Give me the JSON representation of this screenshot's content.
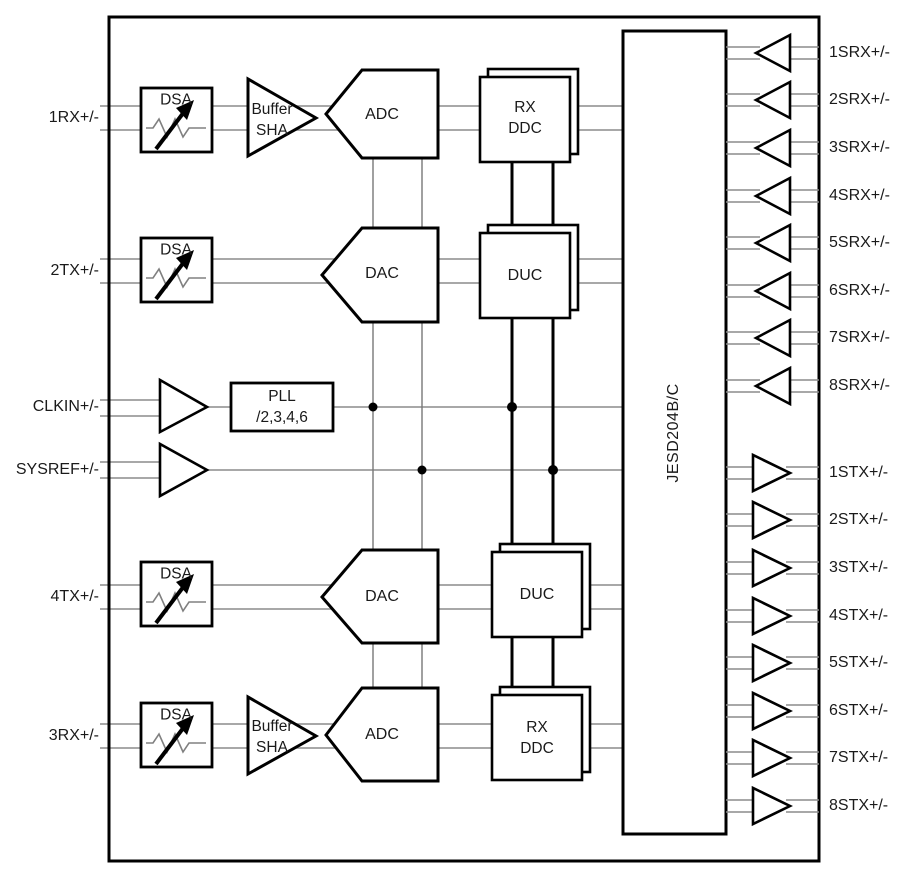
{
  "diagram": {
    "left_pins": [
      "1RX+/-",
      "2TX+/-",
      "CLKIN+/-",
      "SYSREF+/-",
      "4TX+/-",
      "3RX+/-"
    ],
    "srx_pins": [
      "1SRX+/-",
      "2SRX+/-",
      "3SRX+/-",
      "4SRX+/-",
      "5SRX+/-",
      "6SRX+/-",
      "7SRX+/-",
      "8SRX+/-"
    ],
    "stx_pins": [
      "1STX+/-",
      "2STX+/-",
      "3STX+/-",
      "4STX+/-",
      "5STX+/-",
      "6STX+/-",
      "7STX+/-",
      "8STX+/-"
    ],
    "blocks": {
      "dsa": "DSA",
      "buffer_sha": {
        "line1": "Buffer",
        "line2": "SHA"
      },
      "adc": "ADC",
      "dac": "DAC",
      "rx_ddc": {
        "line1": "RX",
        "line2": "DDC"
      },
      "duc": "DUC",
      "pll": {
        "line1": "PLL",
        "line2": "/2,3,4,6"
      },
      "jesd": "JESD204B/C"
    },
    "colors": {
      "background": "#ffffff",
      "block_border": "#000000",
      "signal_line": "#8c8c8c",
      "clock_line": "#777777",
      "bus_line": "#000000",
      "text": "#1a1a1a"
    }
  }
}
